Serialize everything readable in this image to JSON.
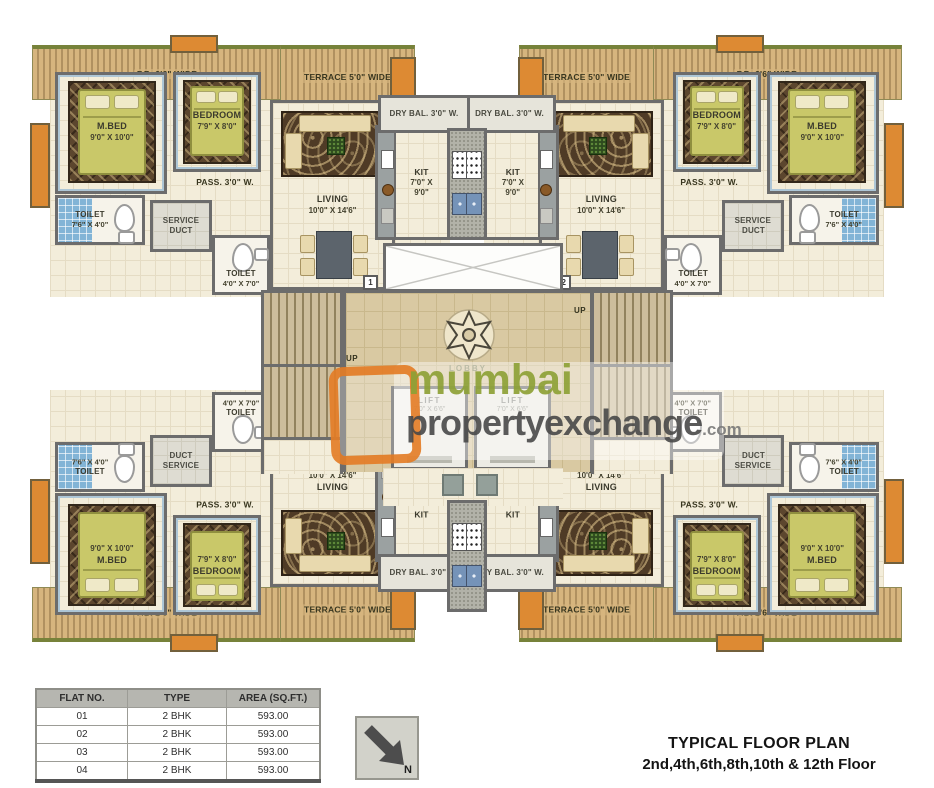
{
  "title": {
    "line1": "TYPICAL FLOOR PLAN",
    "line2": "2nd,4th,6th,8th,10th & 12th Floor"
  },
  "watermark": {
    "brand1": "mumbai",
    "brand2": "propertyexchange",
    "suffix": ".com"
  },
  "north": {
    "label": "N"
  },
  "table": {
    "headers": [
      "FLAT NO.",
      "TYPE",
      "AREA  (SQ.FT.)"
    ],
    "rows": [
      [
        "01",
        "2 BHK",
        "593.00"
      ],
      [
        "02",
        "2 BHK",
        "593.00"
      ],
      [
        "03",
        "2 BHK",
        "593.00"
      ],
      [
        "04",
        "2 BHK",
        "593.00"
      ]
    ]
  },
  "flat": {
    "fb": "F.B. 2'6\" WIDE",
    "terrace": "TERRACE 5'0\" WIDE",
    "mbed_name": "M.BED",
    "mbed_dim": "9'0\" X 10'0\"",
    "bedroom_name": "BEDROOM",
    "bedroom_dim": "7'9\" X 8'0\"",
    "living_name": "LIVING",
    "living_dim": "10'0\" X 14'6\"",
    "pass": "PASS. 3'0\" W.",
    "toilet1_name": "TOILET",
    "toilet1_dim": "7'6\" X 4'0\"",
    "toilet2_name": "TOILET",
    "toilet2_dim": "4'0\" X 7'0\"",
    "service_line1": "SERVICE",
    "service_line2": "DUCT",
    "kit_name": "KIT",
    "kit_dim1": "7'0\" X",
    "kit_dim2": "9'0\"",
    "drybal": "DRY BAL. 3'0\" W."
  },
  "flats": [
    {
      "marker": "1"
    },
    {
      "marker": "2"
    },
    {
      "marker": "3"
    },
    {
      "marker": "4"
    }
  ],
  "core": {
    "lobby": "LOBBY",
    "lift_name": "LIFT",
    "lift_dim": "7'0\" X 6'6\"",
    "up": "UP"
  },
  "colors": {
    "wall": "#6c6c6c",
    "floor": "#f3edda",
    "terrace_tan": "#d6b57e",
    "accent_orange": "#dd8a33",
    "bed_olive": "#c9c869",
    "toilet_blue": "#82b4d6",
    "lobby_tan": "#d9c9a2",
    "brand_green": "#8da136",
    "brand_orange": "#e3781e"
  }
}
